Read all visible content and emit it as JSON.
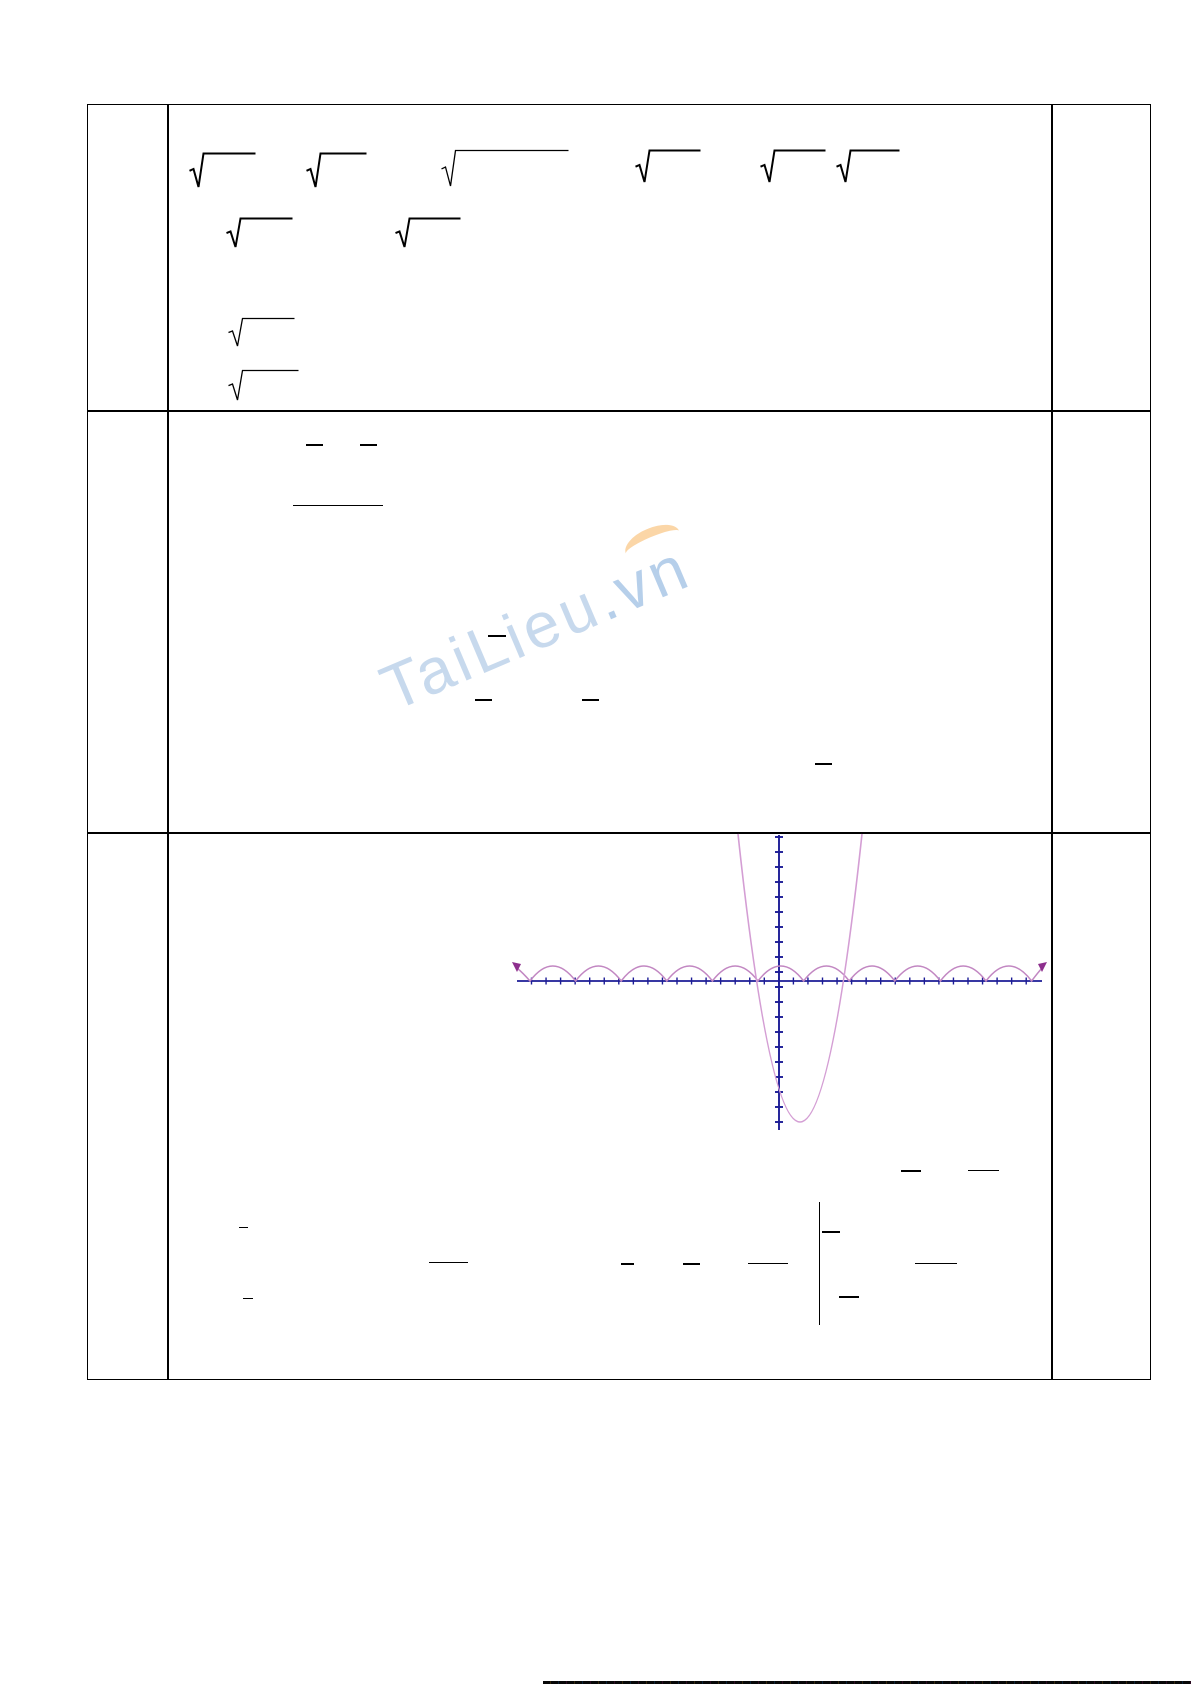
{
  "watermark": {
    "text": "TaiLieu",
    "suffix": ".vn"
  },
  "colors": {
    "table_border": "#000000",
    "axis": "#1c1c96",
    "arch_curve": "#c287c2",
    "parabola": "#d49ed4",
    "curve_arrow": "#8d2f8d",
    "watermark_blue": "#a5c1e2",
    "watermark_orange": "#f8b45f"
  },
  "marks": {
    "radicals": [
      {
        "x": 189,
        "y": 153,
        "bar": 52,
        "h": 36,
        "w": 2
      },
      {
        "x": 306,
        "y": 153,
        "bar": 46,
        "h": 36,
        "w": 2
      },
      {
        "x": 441,
        "y": 150,
        "bar": 113,
        "h": 38,
        "w": 1.3
      },
      {
        "x": 635,
        "y": 150,
        "bar": 51,
        "h": 34,
        "w": 2
      },
      {
        "x": 760,
        "y": 150,
        "bar": 51,
        "h": 34,
        "w": 2
      },
      {
        "x": 836,
        "y": 150,
        "bar": 49,
        "h": 34,
        "w": 2
      },
      {
        "x": 226,
        "y": 218,
        "bar": 52,
        "h": 31,
        "w": 2
      },
      {
        "x": 395,
        "y": 218,
        "bar": 51,
        "h": 31,
        "w": 2
      },
      {
        "x": 228,
        "y": 318,
        "bar": 52,
        "h": 30,
        "w": 1.3
      },
      {
        "x": 228,
        "y": 370,
        "bar": 56,
        "h": 32,
        "w": 1.3
      }
    ],
    "bars": [
      {
        "x": 306,
        "y": 444,
        "w": 17,
        "t": 1.6
      },
      {
        "x": 360,
        "y": 444,
        "w": 17,
        "t": 1.6
      },
      {
        "x": 293,
        "y": 505,
        "w": 90,
        "t": 1.3
      },
      {
        "x": 488,
        "y": 635,
        "w": 18,
        "t": 1.6
      },
      {
        "x": 475,
        "y": 699,
        "w": 17,
        "t": 1.6
      },
      {
        "x": 582,
        "y": 699,
        "w": 17,
        "t": 1.6
      },
      {
        "x": 815,
        "y": 763,
        "w": 17,
        "t": 1.6
      },
      {
        "x": 901,
        "y": 1170,
        "w": 20,
        "t": 1.6
      },
      {
        "x": 968,
        "y": 1170,
        "w": 31,
        "t": 1.3
      },
      {
        "x": 239,
        "y": 1227,
        "w": 9,
        "t": 1.3
      },
      {
        "x": 822,
        "y": 1231,
        "w": 18,
        "t": 1.6
      },
      {
        "x": 429,
        "y": 1262,
        "w": 39,
        "t": 1.3
      },
      {
        "x": 621,
        "y": 1263,
        "w": 13,
        "t": 1.6
      },
      {
        "x": 683,
        "y": 1263,
        "w": 17,
        "t": 1.6
      },
      {
        "x": 748,
        "y": 1263,
        "w": 40,
        "t": 1.3
      },
      {
        "x": 915,
        "y": 1263,
        "w": 42,
        "t": 1.3
      },
      {
        "x": 243,
        "y": 1298,
        "w": 10,
        "t": 1.3
      },
      {
        "x": 839,
        "y": 1296,
        "w": 20,
        "t": 1.6
      }
    ],
    "vlines": [
      {
        "x": 819,
        "y": 1202,
        "h": 123,
        "t": 1.4
      }
    ]
  },
  "graph": {
    "x_axis": {
      "y": 981,
      "x1": 517,
      "x2": 1042,
      "tick_start": 531.5,
      "tick_step": 14.55,
      "tick_end": 1037,
      "tick_half": 3.5
    },
    "y_axis": {
      "x": 779,
      "y1": 835,
      "y2": 1130,
      "tick_start": 837,
      "tick_step": 15,
      "tick_end": 1128,
      "tick_half": 4
    },
    "arch_curve": {
      "zero_start": 530,
      "period": 45.6,
      "amplitude": 15,
      "arches": 11
    },
    "parabola": {
      "x1": 738,
      "x2": 862,
      "y_top": 834,
      "vertex_x": 800,
      "vertex_y": 1122
    }
  },
  "chart_data": {
    "type": "line",
    "title": "",
    "xlabel": "",
    "ylabel": "",
    "legend": false,
    "grid": false,
    "series": [
      {
        "name": "periodic-arch-curve",
        "description": "|sin x|-style repeating arches riding on the x-axis, 11 full arches, period ~45.6px, amplitude ~15px, span x 517-1042, arrowheads at both ends"
      },
      {
        "name": "parabola",
        "description": "upward-opening parabola clipped at cell top, vertex below x-axis at ~(800,1122)px, crossing the x-axis at ~x=757 and ~x=845"
      }
    ],
    "axes": {
      "x": {
        "pixel_y": 981,
        "tick_spacing_px": 14.55,
        "range_px": [
          517,
          1042
        ]
      },
      "y": {
        "pixel_x": 779,
        "tick_spacing_px": 15,
        "range_px": [
          835,
          1130
        ]
      }
    }
  }
}
